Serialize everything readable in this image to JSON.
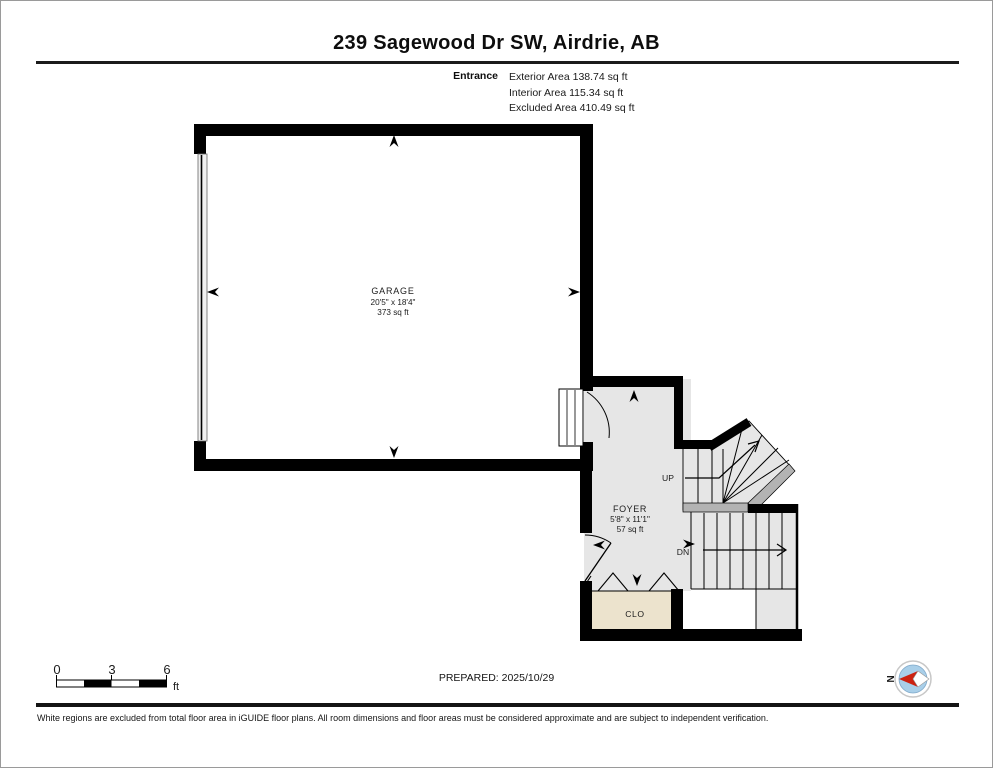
{
  "header": {
    "title": "239 Sagewood Dr SW, Airdrie, AB",
    "floor_label": "Entrance",
    "stats": [
      "Exterior Area 138.74 sq ft",
      "Interior Area 115.34 sq ft",
      "Excluded Area 410.49 sq ft"
    ]
  },
  "rooms": {
    "garage": {
      "name": "GARAGE",
      "dimensions": "20'5\" x 18'4\"",
      "area": "373 sq ft"
    },
    "foyer": {
      "name": "FOYER",
      "dimensions": "5'8\" x 11'1\"",
      "area": "57 sq ft"
    },
    "closet": {
      "name": "CLO"
    }
  },
  "stairs": {
    "up_label": "UP",
    "down_label": "DN"
  },
  "scale_bar": {
    "ticks": [
      "0",
      "3",
      "6"
    ],
    "unit": "ft"
  },
  "footer": {
    "prepared": "PREPARED: 2025/10/29",
    "compass_north": "N",
    "disclaimer": "White regions are excluded from total floor area in iGUIDE floor plans. All room dimensions and floor areas must be considered approximate and are subject to independent verification."
  },
  "colors": {
    "wall_black": "#000000",
    "floor_gray": "#e6e6e6",
    "closet_beige": "#ece3cd",
    "railing_gray": "#b3b3b3",
    "compass_blue": "#a9cfe9",
    "compass_red": "#cc2211"
  }
}
